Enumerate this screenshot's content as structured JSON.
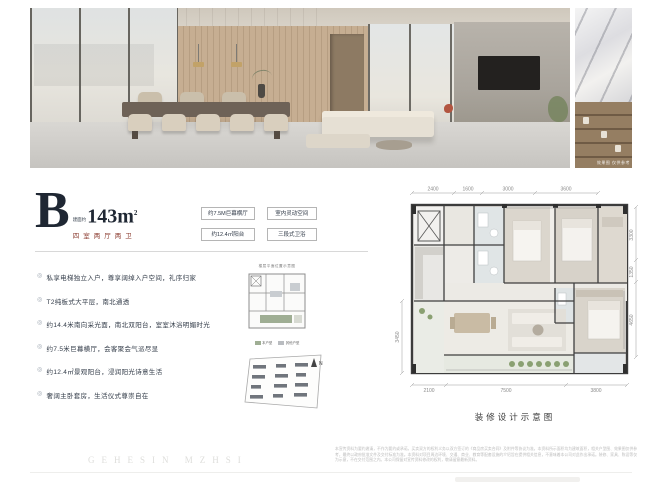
{
  "colors": {
    "accent_dark": "#1f2733",
    "accent_red": "#8a3a2e",
    "plan_wall": "#3c3c3c",
    "plan_green": "#8aa072"
  },
  "marker": "◎",
  "unit": {
    "letter": "B",
    "area_label": "建面约",
    "area_value": "143m",
    "area_sup": "2",
    "layout": "四室两厅两卫"
  },
  "photo": {
    "caption": "效果图 仅供参考"
  },
  "tags": [
    "约7.5M巨幕横厅",
    "室内灵动空间",
    "约12.4㎡阳台",
    "三段式卫浴"
  ],
  "bullets": [
    "私享电梯独立入户，尊享阔绰入户空间，礼序归家",
    "T2纯板式大平层，南北通透",
    "约14.4米南向采光面，南北双阳台，室室沐浴明媚时光",
    "约7.5米巨幕横厅，会客聚会气派尽显",
    "约12.4㎡景观阳台，浸润阳光诗意生活",
    "奢阔主卧套房，生活仪式尊崇自在"
  ],
  "keyplan": {
    "title": "楼层平面位置示意图",
    "legend": [
      {
        "label": "本户型"
      },
      {
        "label": "其他户型"
      }
    ]
  },
  "siteplan": {
    "north_label": "N"
  },
  "floorplan": {
    "caption": "装修设计示意图",
    "dims_top": [
      "2400",
      "1600",
      "3000",
      "3600"
    ],
    "dims_right": [
      "3300",
      "1350",
      "4650"
    ],
    "dims_left": [
      "3450"
    ],
    "dims_bottom": [
      "2100",
      "7500",
      "3800"
    ]
  },
  "watermark": "GEHESIN MZHSI",
  "disclaimer": "本宣传资料为要约邀请，不作为要约或承诺，买卖双方的权利义务以双方签订的《商品房买卖合同》及附件等协议为准。本资料所示面积均为建筑面积，相关户型图、效果图仅供参考，最终以政府批准文件及交付标准为准。本资料对项目周边环境、交通、商业、教育等配套设施的介绍旨在提供相关信息，不意味着本公司对此作出承诺。装修、家具、陈设等仅为示意，不在交付范围之内。本公司保留对宣传资料修改的权利，敬请留意最新资料。"
}
